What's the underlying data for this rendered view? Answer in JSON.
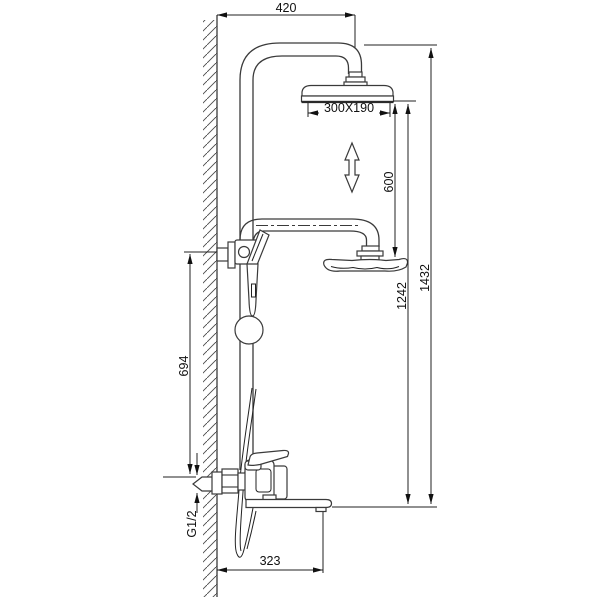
{
  "drawing": {
    "type": "technical-dimension-drawing",
    "subject": "wall-mounted shower column with overhead shower, hand shower and bath spout"
  },
  "dimensions": {
    "top_offset": "420",
    "overhead_size": "300X190",
    "adjust_range": "600",
    "head_height": "1242",
    "total_height": "1432",
    "bracket_height": "694",
    "inlet_thread": "G1/2",
    "spout_reach": "323"
  }
}
